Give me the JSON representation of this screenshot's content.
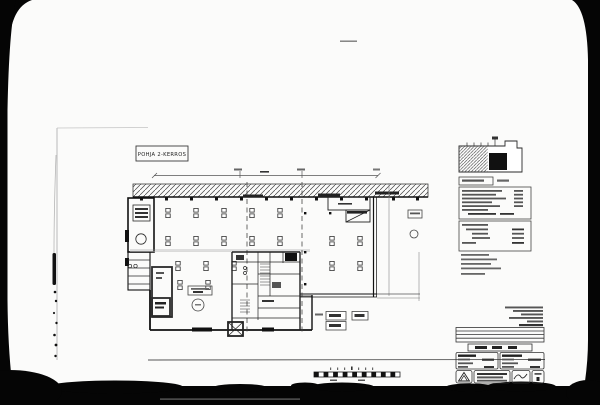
{
  "scan": {
    "background_color": "#040404",
    "paper_color": "#fbfbfa",
    "ink_color": "#1f1f1f"
  },
  "plan": {
    "floor_label": "POHJA 2-KERROS"
  },
  "scale_bar": {
    "segment_count": 18
  }
}
